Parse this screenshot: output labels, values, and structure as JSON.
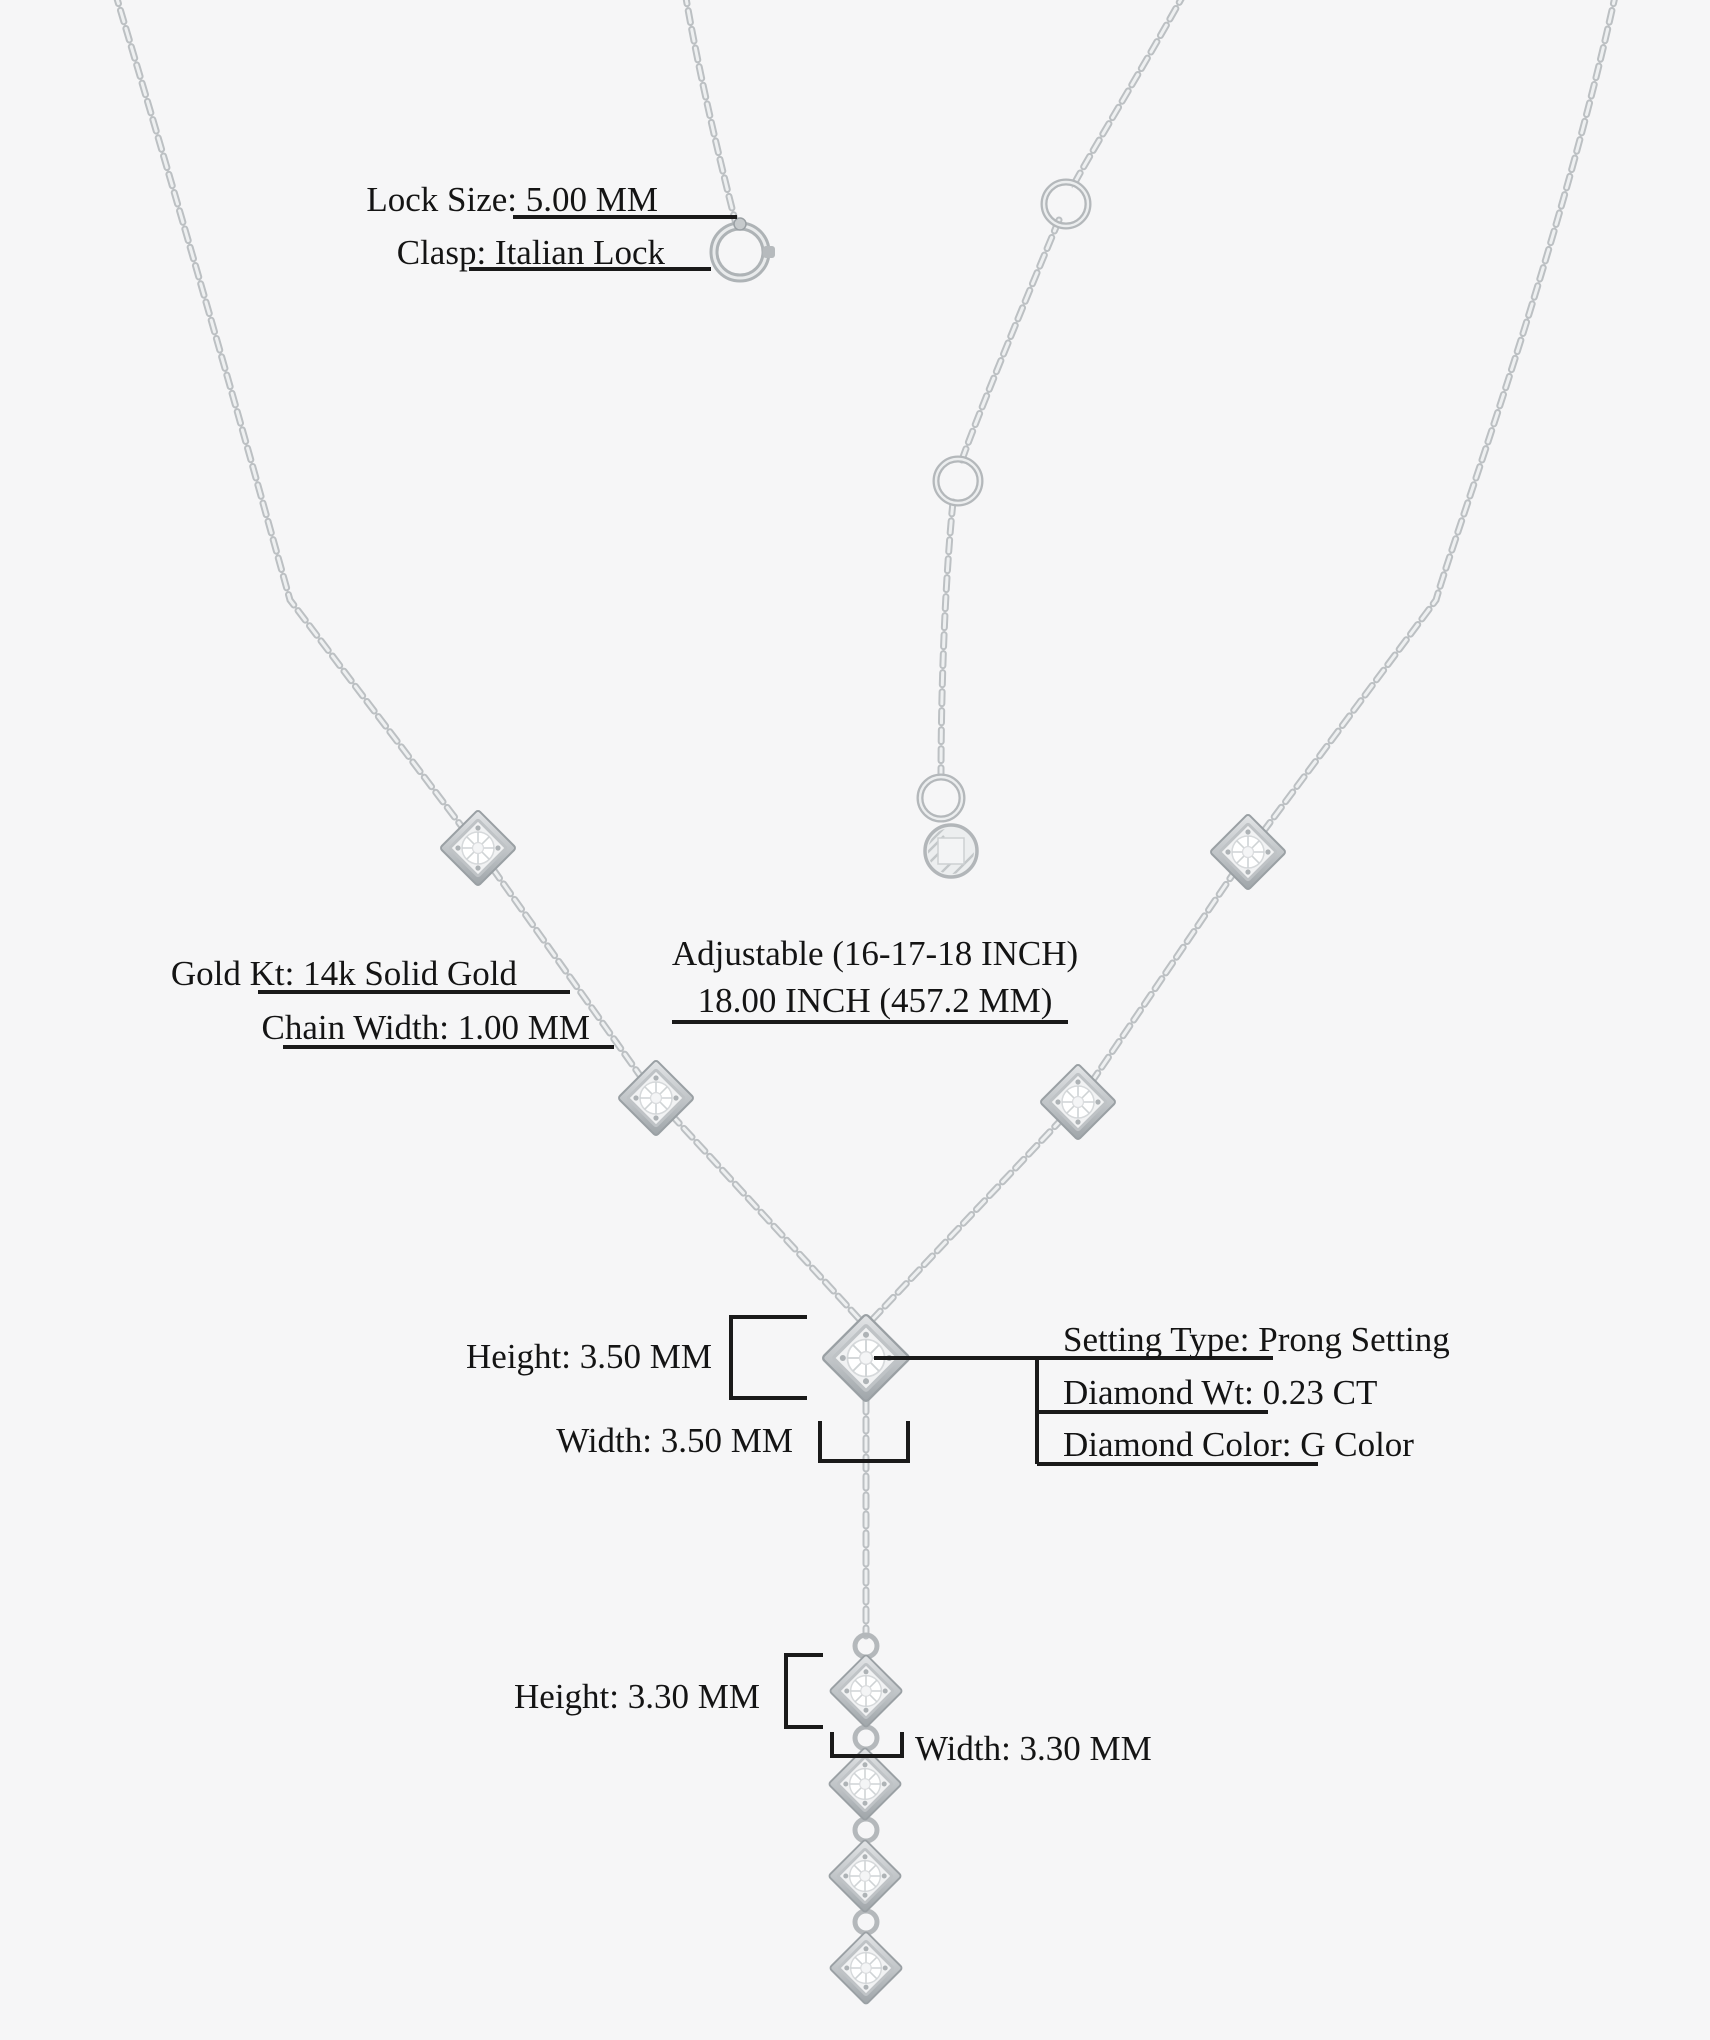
{
  "canvas": {
    "width_px": 1710,
    "height_px": 2040,
    "background": "#f6f6f7"
  },
  "specs": {
    "lock_size": "Lock Size: 5.00 MM",
    "clasp": "Clasp: Italian Lock",
    "gold_kt": "Gold Kt: 14k Solid Gold",
    "chain_width": "Chain Width: 1.00 MM",
    "adjustable": "Adjustable (16-17-18 INCH)",
    "length": "18.00 INCH (457.2 MM)",
    "pendant_height": "Height: 3.50 MM",
    "pendant_width": "Width: 3.50 MM",
    "setting_type": "Setting Type: Prong Setting",
    "diamond_weight": "Diamond Wt: 0.23 CT",
    "diamond_color": "Diamond Color: G Color",
    "drop_height": "Height: 3.30 MM",
    "drop_width": "Width: 3.30 MM"
  },
  "colors": {
    "background": "#f6f6f7",
    "annotation_line": "#1a1a1a",
    "text": "#141414",
    "metal": "#c2c6c9",
    "metal_light": "#edeeef",
    "metal_dark": "#a7acb0"
  },
  "necklace": {
    "station_count": 4,
    "drop_diamond_count": 4,
    "extender_ring_count": 2,
    "has_spring_ring_clasp": true,
    "has_logo_disc_tag": true
  }
}
